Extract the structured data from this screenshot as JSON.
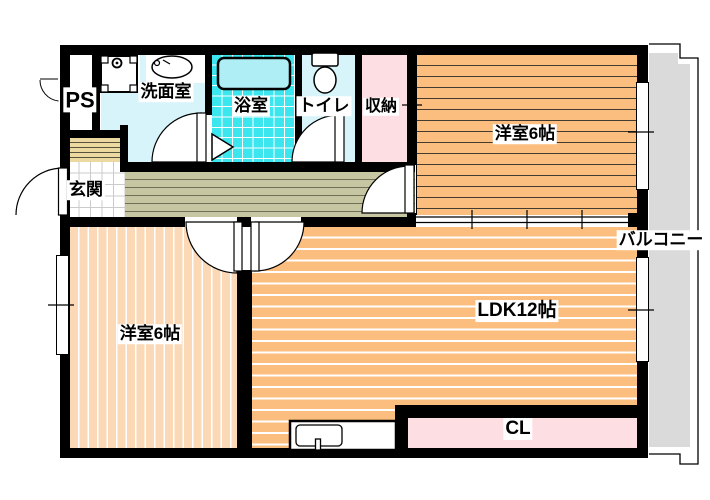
{
  "plan": {
    "rooms": {
      "ps": {
        "label": "PS"
      },
      "washroom": {
        "label": "洗面室"
      },
      "bathroom": {
        "label": "浴室"
      },
      "toilet": {
        "label": "トイレ"
      },
      "storage": {
        "label": "収納"
      },
      "bedroom_ne": {
        "label": "洋室6帖"
      },
      "balcony": {
        "label": "バルコニー"
      },
      "entrance": {
        "label": "玄関"
      },
      "bedroom_sw": {
        "label": "洋室6帖"
      },
      "ldk": {
        "label": "LDK12帖"
      },
      "closet": {
        "label": "CL"
      }
    },
    "colors": {
      "wall": "#000000",
      "tatami_orange": "#FBBE7E",
      "bedroom_peach": "#FBD8B6",
      "hallway_olive": "#C7C6A2",
      "step_tan": "#EBD9A0",
      "wet_area_cyan": "#D6F4F9",
      "bath_tile_cyan": "#3BE6EF",
      "closet_pink": "#FDDEE3",
      "balcony_gray": "#DADADA"
    }
  }
}
